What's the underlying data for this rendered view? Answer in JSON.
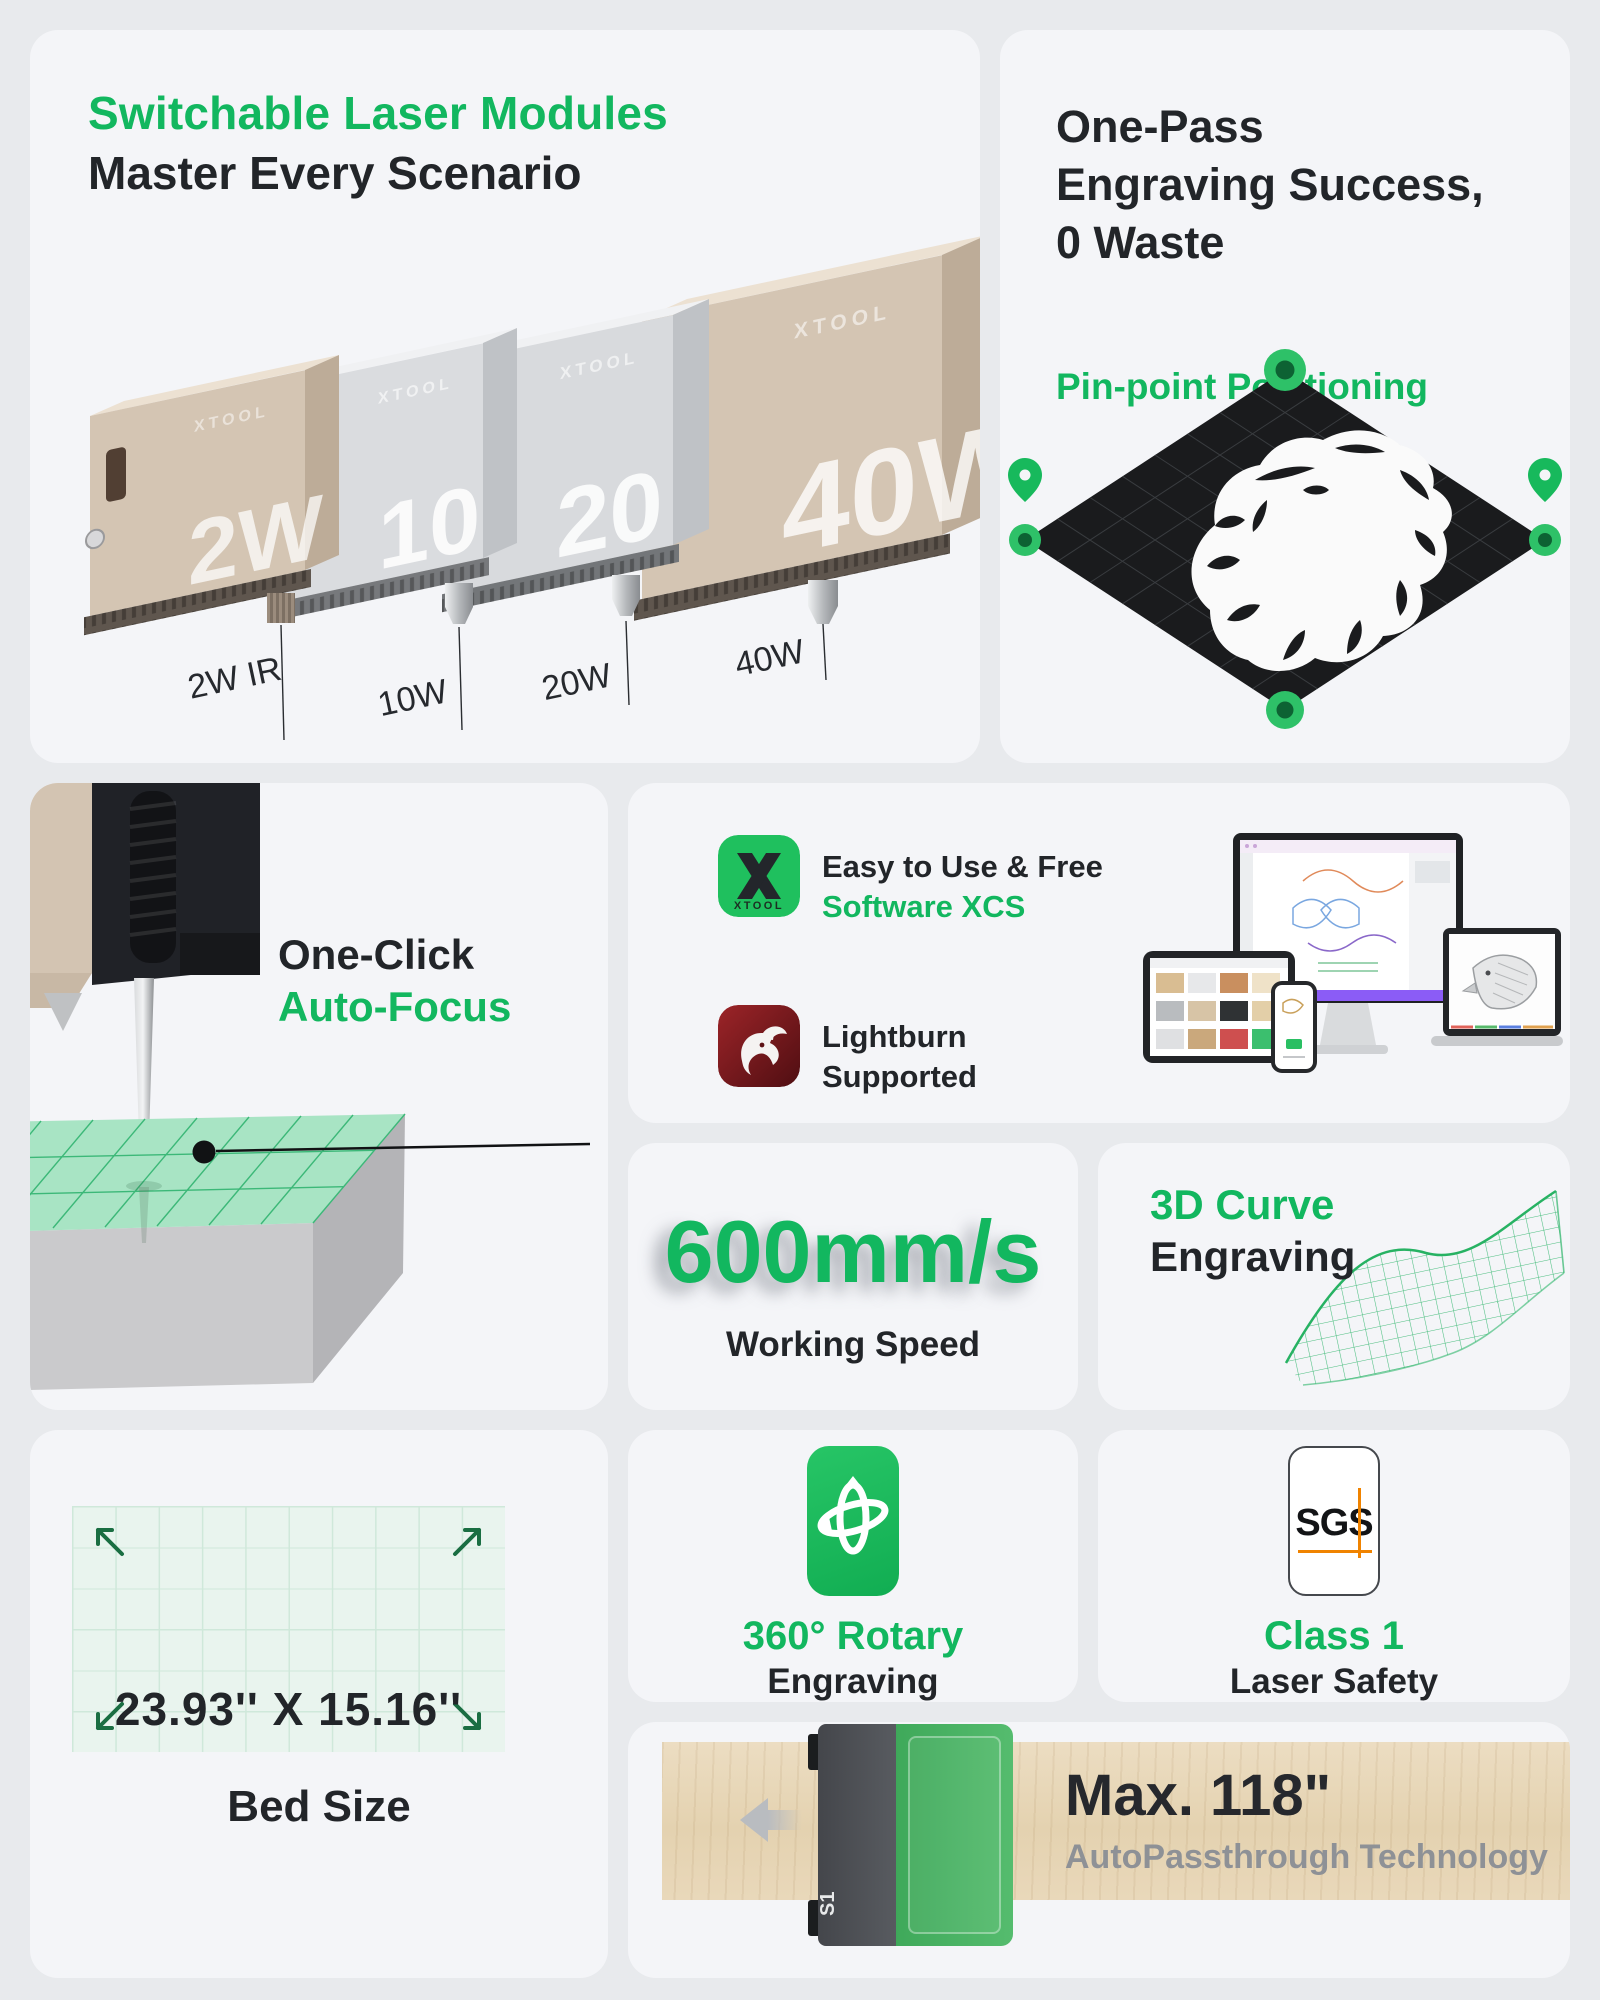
{
  "theme": {
    "page_bg": "#e8eaed",
    "card_bg": "#f4f5f8",
    "accent_green": "#12b75f",
    "dark_text": "#222529",
    "gray_text": "#8e9196",
    "sgs_orange": "#f08300"
  },
  "modules_card": {
    "title": "Switchable Laser Modules",
    "subtitle": "Master Every Scenario",
    "brand_mark": "XTOOL",
    "face_marks": [
      "2W",
      "10",
      "20",
      "40W"
    ],
    "labels": [
      "2W IR",
      "10W",
      "20W",
      "40W"
    ]
  },
  "onepass_card": {
    "title_line1": "One-Pass",
    "title_line2": "Engraving Success,",
    "title_line3": "0 Waste",
    "subtitle": "Pin-point Positioning"
  },
  "autofocus_card": {
    "title_dark": "One-Click",
    "title_green": "Auto-Focus"
  },
  "software_card": {
    "xcs_heading": "Easy to Use & Free",
    "xcs_subheading": "Software XCS",
    "xcs_logo_label": "XTOOL",
    "lightburn_line1": "Lightburn",
    "lightburn_line2": "Supported"
  },
  "speed_card": {
    "value": "600mm/s",
    "label": "Working Speed"
  },
  "curve_card": {
    "title_green": "3D Curve",
    "title_dark": "Engraving"
  },
  "bed_card": {
    "dimensions": "23.93'' X 15.16''",
    "label": "Bed Size"
  },
  "rotary_card": {
    "title_green": "360° Rotary",
    "title_dark": "Engraving"
  },
  "safety_card": {
    "badge": "SGS",
    "title_green": "Class 1",
    "title_dark": "Laser Safety"
  },
  "passthrough_card": {
    "title": "Max. 118\"",
    "subtitle": "AutoPassthrough Technology",
    "machine_label": "S1"
  }
}
